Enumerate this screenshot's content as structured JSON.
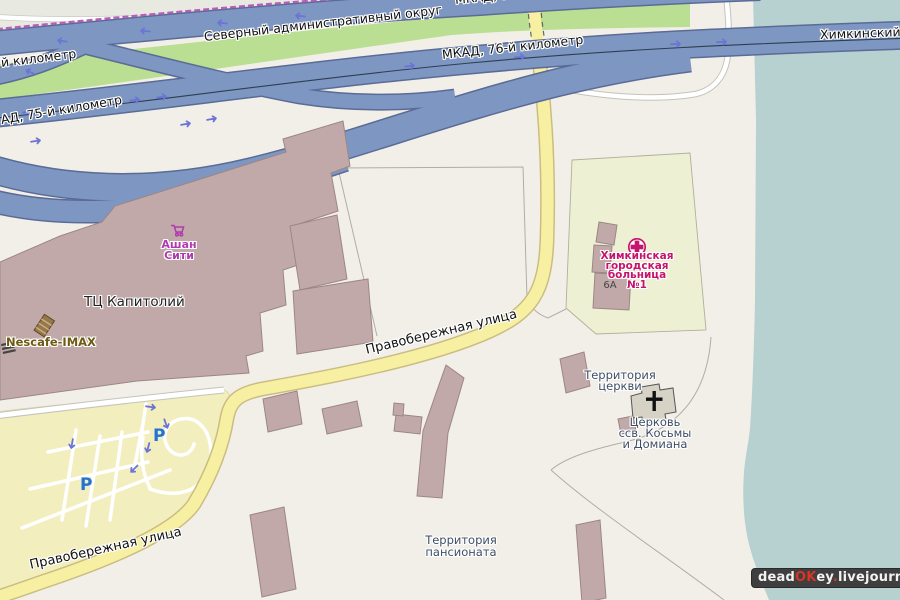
{
  "roads": {
    "district_label": "Северный административный округ",
    "mkad76_top_label": "МКАД, 76-й километр",
    "mkad76_label": "МКАД, 76-й километр",
    "mkad75_label": "АД, 75-й километр",
    "mkad75_partial_label": "й километр",
    "bridge_label": "Химкинский",
    "pravoberezhnaya_label": "Правобережная улица",
    "pravoberezhnaya_label2": "Правобережная улица"
  },
  "places": {
    "mall_label": "ТЦ Капитолий",
    "ashan_lines": [
      "Ашан",
      "Сити"
    ],
    "nescafe_label": "Nescafe-IMAX",
    "hospital_lines": [
      "Химкинская",
      "городская",
      "больница",
      "№1"
    ],
    "hospital_house_number": "6А",
    "church_territory_lines": [
      "Территория",
      "церкви"
    ],
    "church_lines": [
      "Церковь",
      "ссв. Косьмы",
      "и Домиана"
    ],
    "pansionat_lines": [
      "Территория",
      "пансионата"
    ],
    "parking_icon_letter": "P"
  },
  "attribution": {
    "parts": [
      {
        "t": "dead"
      },
      {
        "t": "OK"
      },
      {
        "t": "ey"
      },
      {
        "t": "."
      },
      {
        "t": "livejournal"
      },
      {
        "t": "."
      },
      {
        "t": "com"
      }
    ]
  },
  "colors": {
    "land": "#f2efe9",
    "water": "#b7d0d0",
    "green": "#bbdf92",
    "motorway": "#7e97c2",
    "motorway_casing": "#5a6b96",
    "building": "#c2a9a9",
    "church_building": "#d6d2c6",
    "hospital_area": "#edf0d2",
    "parking_area": "#f3eebd",
    "road_yellow": "#f7f0a2",
    "boundary_pink": "#bb5cbb",
    "arrow_blue": "#6c74d6",
    "hospital_label": "#c5146e",
    "shop_label": "#b03ab0",
    "territory_label": "#3e4e66",
    "nescafe_label": "#6e5a10",
    "parking_icon": "#2a72c8"
  }
}
